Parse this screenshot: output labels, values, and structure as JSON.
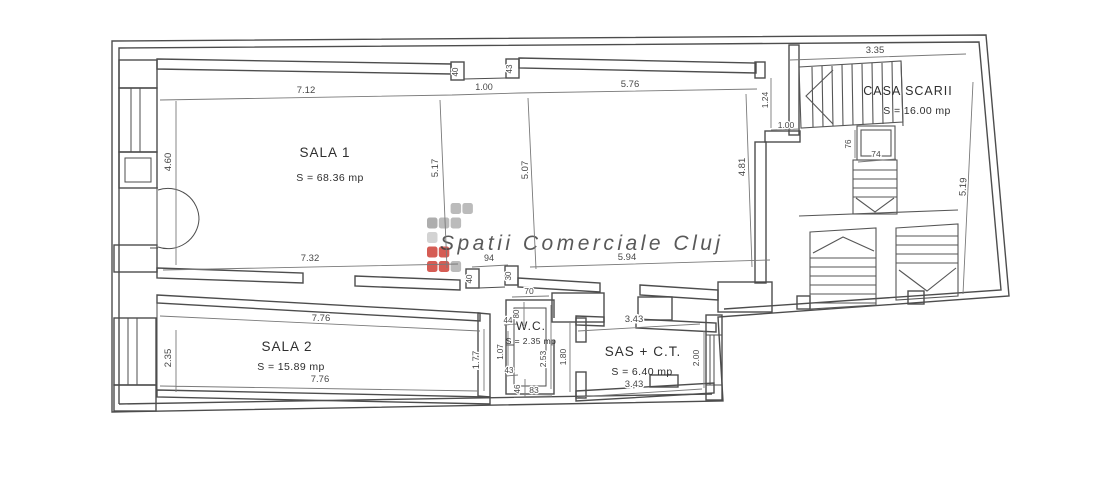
{
  "watermark": {
    "text": "Spatii Comerciale Cluj",
    "colors": {
      "gray": "#b4b4b4",
      "dark_gray": "#a6a6a6",
      "light_gray": "#cfcfcf",
      "red": "#d14b42",
      "text": "#c6c6c6"
    }
  },
  "rooms": {
    "sala1": {
      "name": "SALA 1",
      "area": "S = 68.36 mp"
    },
    "sala2": {
      "name": "SALA 2",
      "area": "S = 15.89 mp"
    },
    "wc": {
      "name": "W.C.",
      "area": "S = 2.35 mp"
    },
    "sas": {
      "name": "SAS + C.T.",
      "area": "S = 6.40 mp"
    },
    "casa_scarii": {
      "name": "CASA SCARII",
      "area": "S = 16.00 mp"
    }
  },
  "dims": {
    "sala1_top_left": "7.12",
    "sala1_top_mid": "1.00",
    "sala1_top_right": "5.76",
    "sala1_left": "4.60",
    "sala1_mid1": "5.17",
    "sala1_mid2": "5.07",
    "sala1_right": "4.81",
    "alcove_left": "40",
    "alcove_right": "43",
    "sala1_bottom_left": "7.32",
    "passage": "94",
    "sala1_bottom_right": "5.94",
    "notch_left": "40",
    "notch_right": "30",
    "stair_hall": "1.24",
    "stair_wall": "1.00",
    "casa_top": "3.35",
    "casa_right": "5.19",
    "shaft_width": "74",
    "shaft_height": "76",
    "sala2_top": "7.76",
    "sala2_bottom": "7.76",
    "sala2_left": "2.35",
    "sala2_right": "1.77",
    "wc_top": "70",
    "wc_left_upper": "80",
    "wc_step_upper": "44",
    "wc_left_mid": "1.07",
    "wc_step_lower": "43",
    "wc_bottom_step": "46",
    "wc_bottom": "83",
    "wc_height": "2.53",
    "corridor_height": "1.80",
    "sas_top": "3.43",
    "sas_bottom": "3.43",
    "sas_right": "2.00"
  }
}
